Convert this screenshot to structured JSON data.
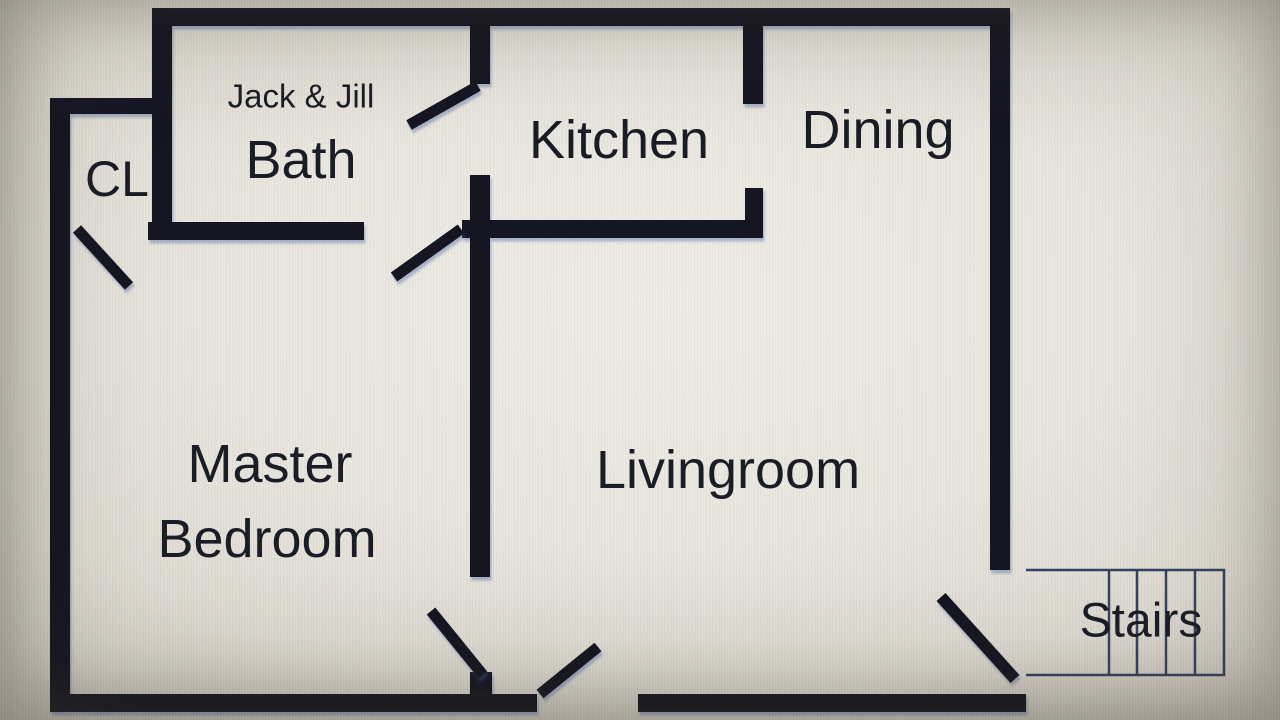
{
  "colors": {
    "background": "#e8e5de",
    "wall": "#161821",
    "label_text": "#1b1d26",
    "stairs_outline": "#35425f"
  },
  "floorplan": {
    "rooms": {
      "bath": {
        "label_line1": "Jack & Jill",
        "label_line2": "Bath"
      },
      "closet": {
        "label": "CL"
      },
      "kitchen": {
        "label": "Kitchen"
      },
      "dining": {
        "label": "Dining"
      },
      "master_bedroom": {
        "label_line1": "Master",
        "label_line2": "Bedroom"
      },
      "living_room": {
        "label": "Livingroom"
      },
      "stairs": {
        "label": "Stairs",
        "tread_count": 4
      }
    }
  }
}
